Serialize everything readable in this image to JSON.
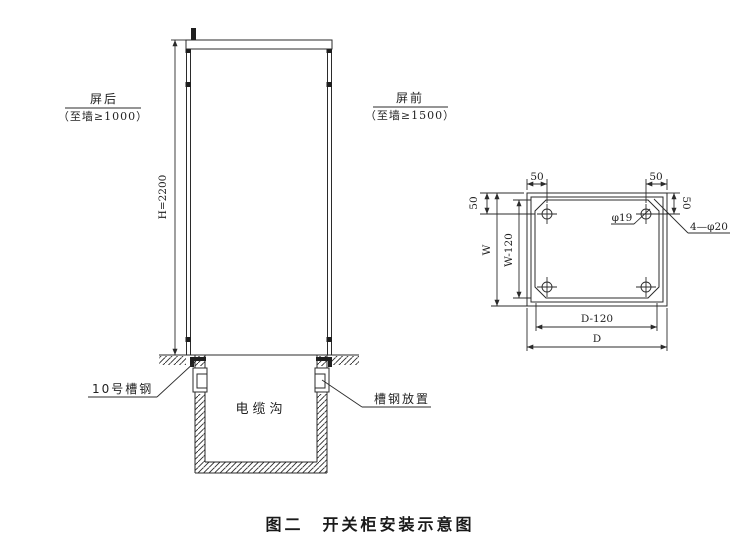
{
  "figure": {
    "caption": "图二　开关柜安装示意图"
  },
  "elevation": {
    "rear_label": "屏后",
    "rear_clearance": "（至墙≥1000）",
    "front_label": "屏前",
    "front_clearance": "（至墙≥1500）",
    "height_dim": "H=2200",
    "channel_steel_label": "10号槽钢",
    "cable_trench_label": "电缆沟",
    "channel_placement_label": "槽钢放置"
  },
  "plan": {
    "dims": {
      "top_left_50": "50",
      "top_right_50": "50",
      "left_50": "50",
      "right_50": "50",
      "width": "W",
      "width_minus": "W-120",
      "depth_minus": "D-120",
      "depth": "D"
    },
    "hole_diameter": "φ19",
    "holes_callout": "4—φ20"
  },
  "colors": {
    "line": "#2b2b2b",
    "text": "#222222",
    "background": "#ffffff",
    "solid_fill": "#1f1f1f"
  }
}
